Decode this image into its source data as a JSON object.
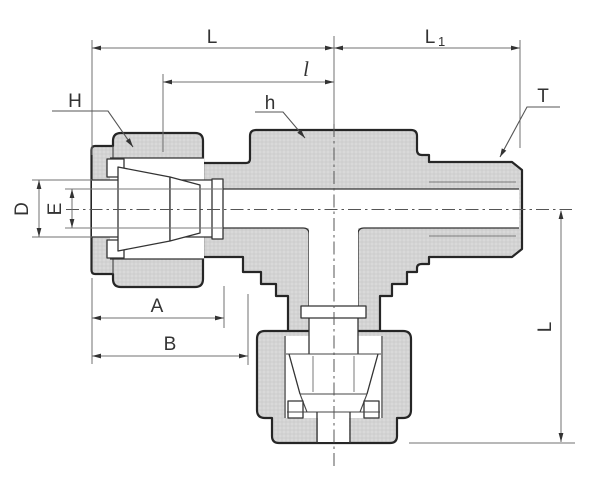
{
  "drawing": {
    "kind": "technical-drawing",
    "subject": "branch-tee-compression-tube-fitting-cross-section",
    "dims": {
      "L_top": "L",
      "L1_main": "L",
      "L1_sub": "1",
      "l_inner": "l",
      "H": "H",
      "h": "h",
      "T": "T",
      "D": "D",
      "E": "E",
      "A": "A",
      "B": "B",
      "L_side": "L"
    },
    "colors": {
      "background": "#ffffff",
      "outline": "#262626",
      "detail_line": "#3a3a3a",
      "dim_line": "#707070",
      "metal_fill": "#d9d9d9",
      "metal_grid": "#c9c9c9",
      "label": "#333333"
    }
  }
}
